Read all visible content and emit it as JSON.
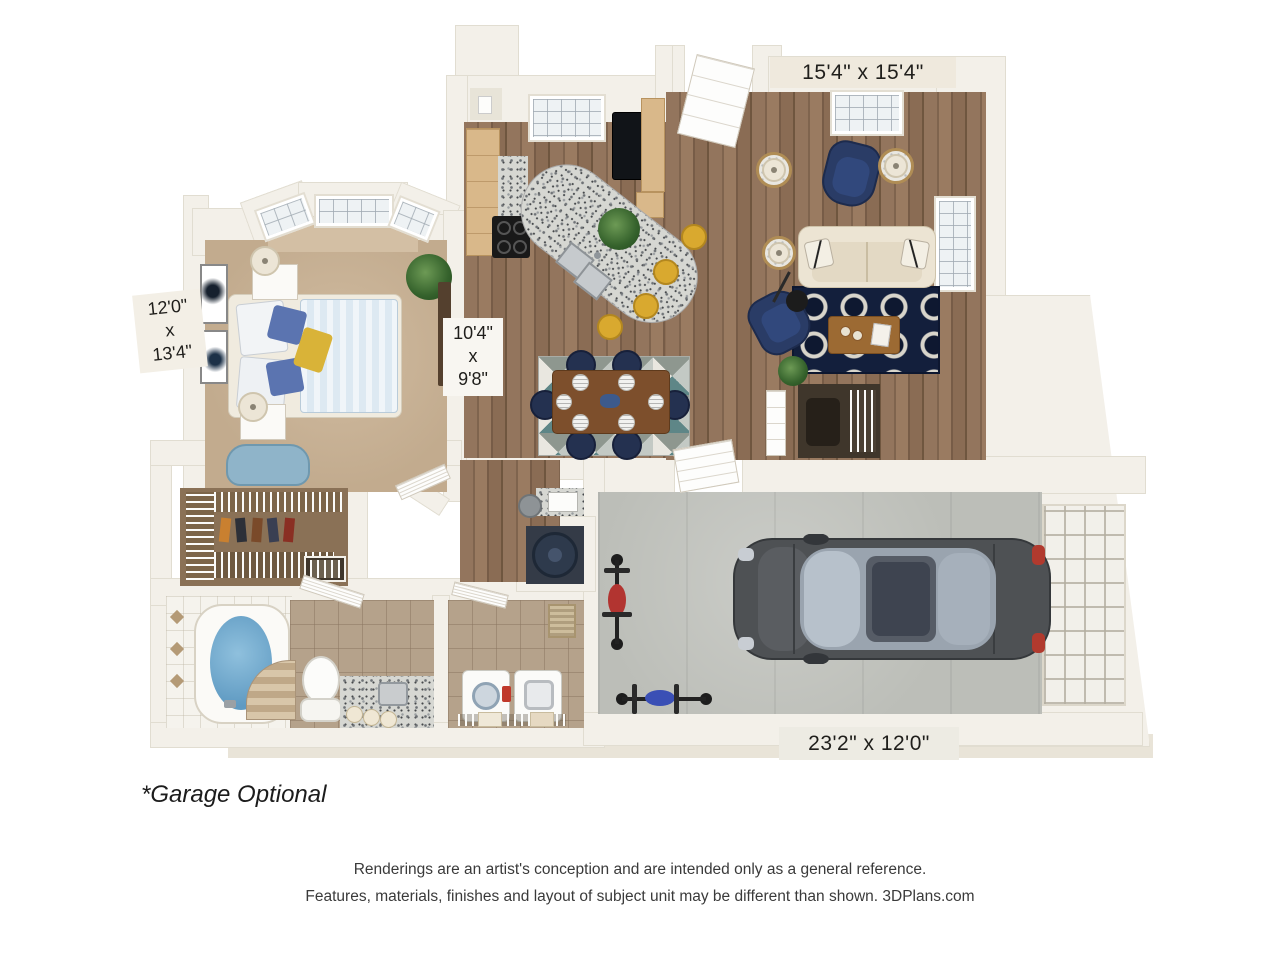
{
  "plan": {
    "labels": {
      "living_room": "15'4\" x 15'4\"",
      "bedroom": [
        "12'0\"",
        "x",
        "13'4\""
      ],
      "kitchen_dining": [
        "10'4\"",
        "x",
        "9'8\""
      ],
      "garage": "23'2\" x 12'0\""
    },
    "footnote": "*Garage Optional",
    "disclaimer": {
      "line1": "Renderings are an artist's conception and are intended only as a general reference.",
      "line2": "Features, materials, finishes and layout of subject unit may be different than shown. 3DPlans.com"
    },
    "colors": {
      "wall": "#f3f0e9",
      "slab": "#e9e4d8",
      "hardwood": "#8d6f57",
      "carpet": "#c8b196",
      "tile": "#b5a28b",
      "concrete": "#bcbeb8",
      "navy_furniture": "#243150",
      "navy_rug": "#131f3c",
      "sofa_cream": "#ece4d3",
      "stool_yellow": "#d9a92f",
      "tub_water": "#74a9cc",
      "car_body": "#4e5154"
    }
  }
}
